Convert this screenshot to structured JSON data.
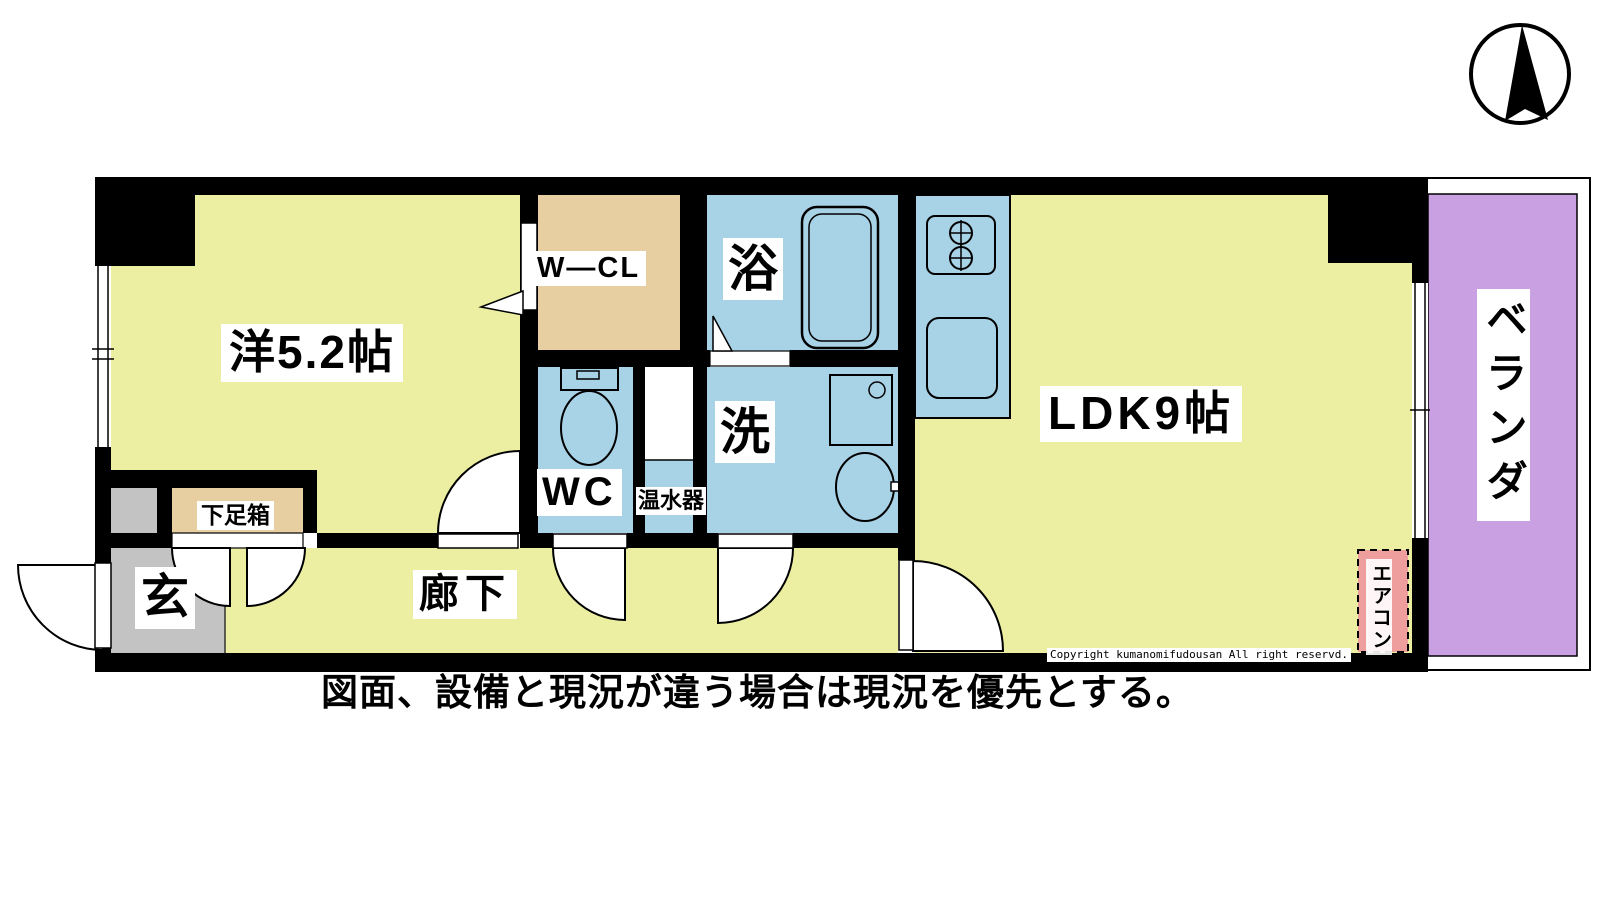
{
  "rooms": {
    "western": {
      "label": "洋5.2帖"
    },
    "walk_in_closet convenience": null,
    "walk_in_closet": {
      "label": "W―CL"
    },
    "bath": {
      "label": "浴"
    },
    "washroom": {
      "label": "洗"
    },
    "wc": {
      "label": "WC"
    },
    "water_heater": {
      "label": "温水器"
    },
    "ldk": {
      "label": "LDK9帖"
    },
    "corridor": {
      "label": "廊下"
    },
    "entrance": {
      "label": "玄"
    },
    "shoe_box": {
      "label": "下足箱"
    },
    "veranda": {
      "label": "ベランダ"
    },
    "aircon": {
      "label": "エアコン"
    }
  },
  "notes": {
    "copyright": "Copyright kumanomifudousan All right reservd.",
    "caption": "図面、設備と現況が違う場合は現況を優先とする。"
  },
  "compass": {
    "icon": "north-arrow"
  },
  "colors": {
    "wall": "#000000",
    "floor_yellow": "#ecefa2",
    "water_blue": "#a8d2e6",
    "closet_tan": "#e8cfa2",
    "entry_gray": "#c3c3c3",
    "veranda_purple": "#c9a1e2",
    "aircon_pink": "#ef9e9e",
    "white": "#ffffff"
  }
}
